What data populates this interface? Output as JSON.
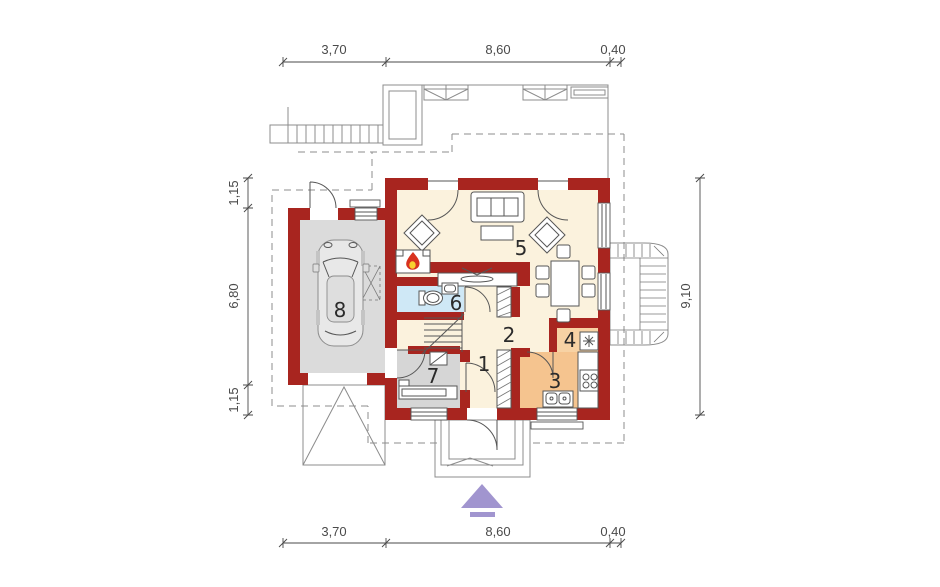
{
  "dimensions": {
    "top": [
      "3,70",
      "8,60",
      "0,40"
    ],
    "bottom": [
      "3,70",
      "8,60",
      "0,40"
    ],
    "left": [
      "1,15",
      "6,80",
      "1,15"
    ],
    "right": "9,10"
  },
  "rooms": {
    "hall": "1",
    "corridor": "2",
    "kitchen": "3",
    "pantry": "4",
    "living_room": "5",
    "wc": "6",
    "utility": "7",
    "garage": "8"
  },
  "colors": {
    "wall": "#a8251f",
    "floor_main": "#fbf2dd",
    "floor_kitchen": "#f5c48f",
    "floor_pantry": "#f7d2a4",
    "floor_wc": "#cfe8f6",
    "floor_garage": "#dbdbdb",
    "floor_utility": "#d6d6d6",
    "site": "#8c8c8c",
    "dimension": "#4a4a4a",
    "arrow": "#a195cf",
    "flame_red": "#d8321f",
    "flame_yellow": "#f8d22f"
  }
}
